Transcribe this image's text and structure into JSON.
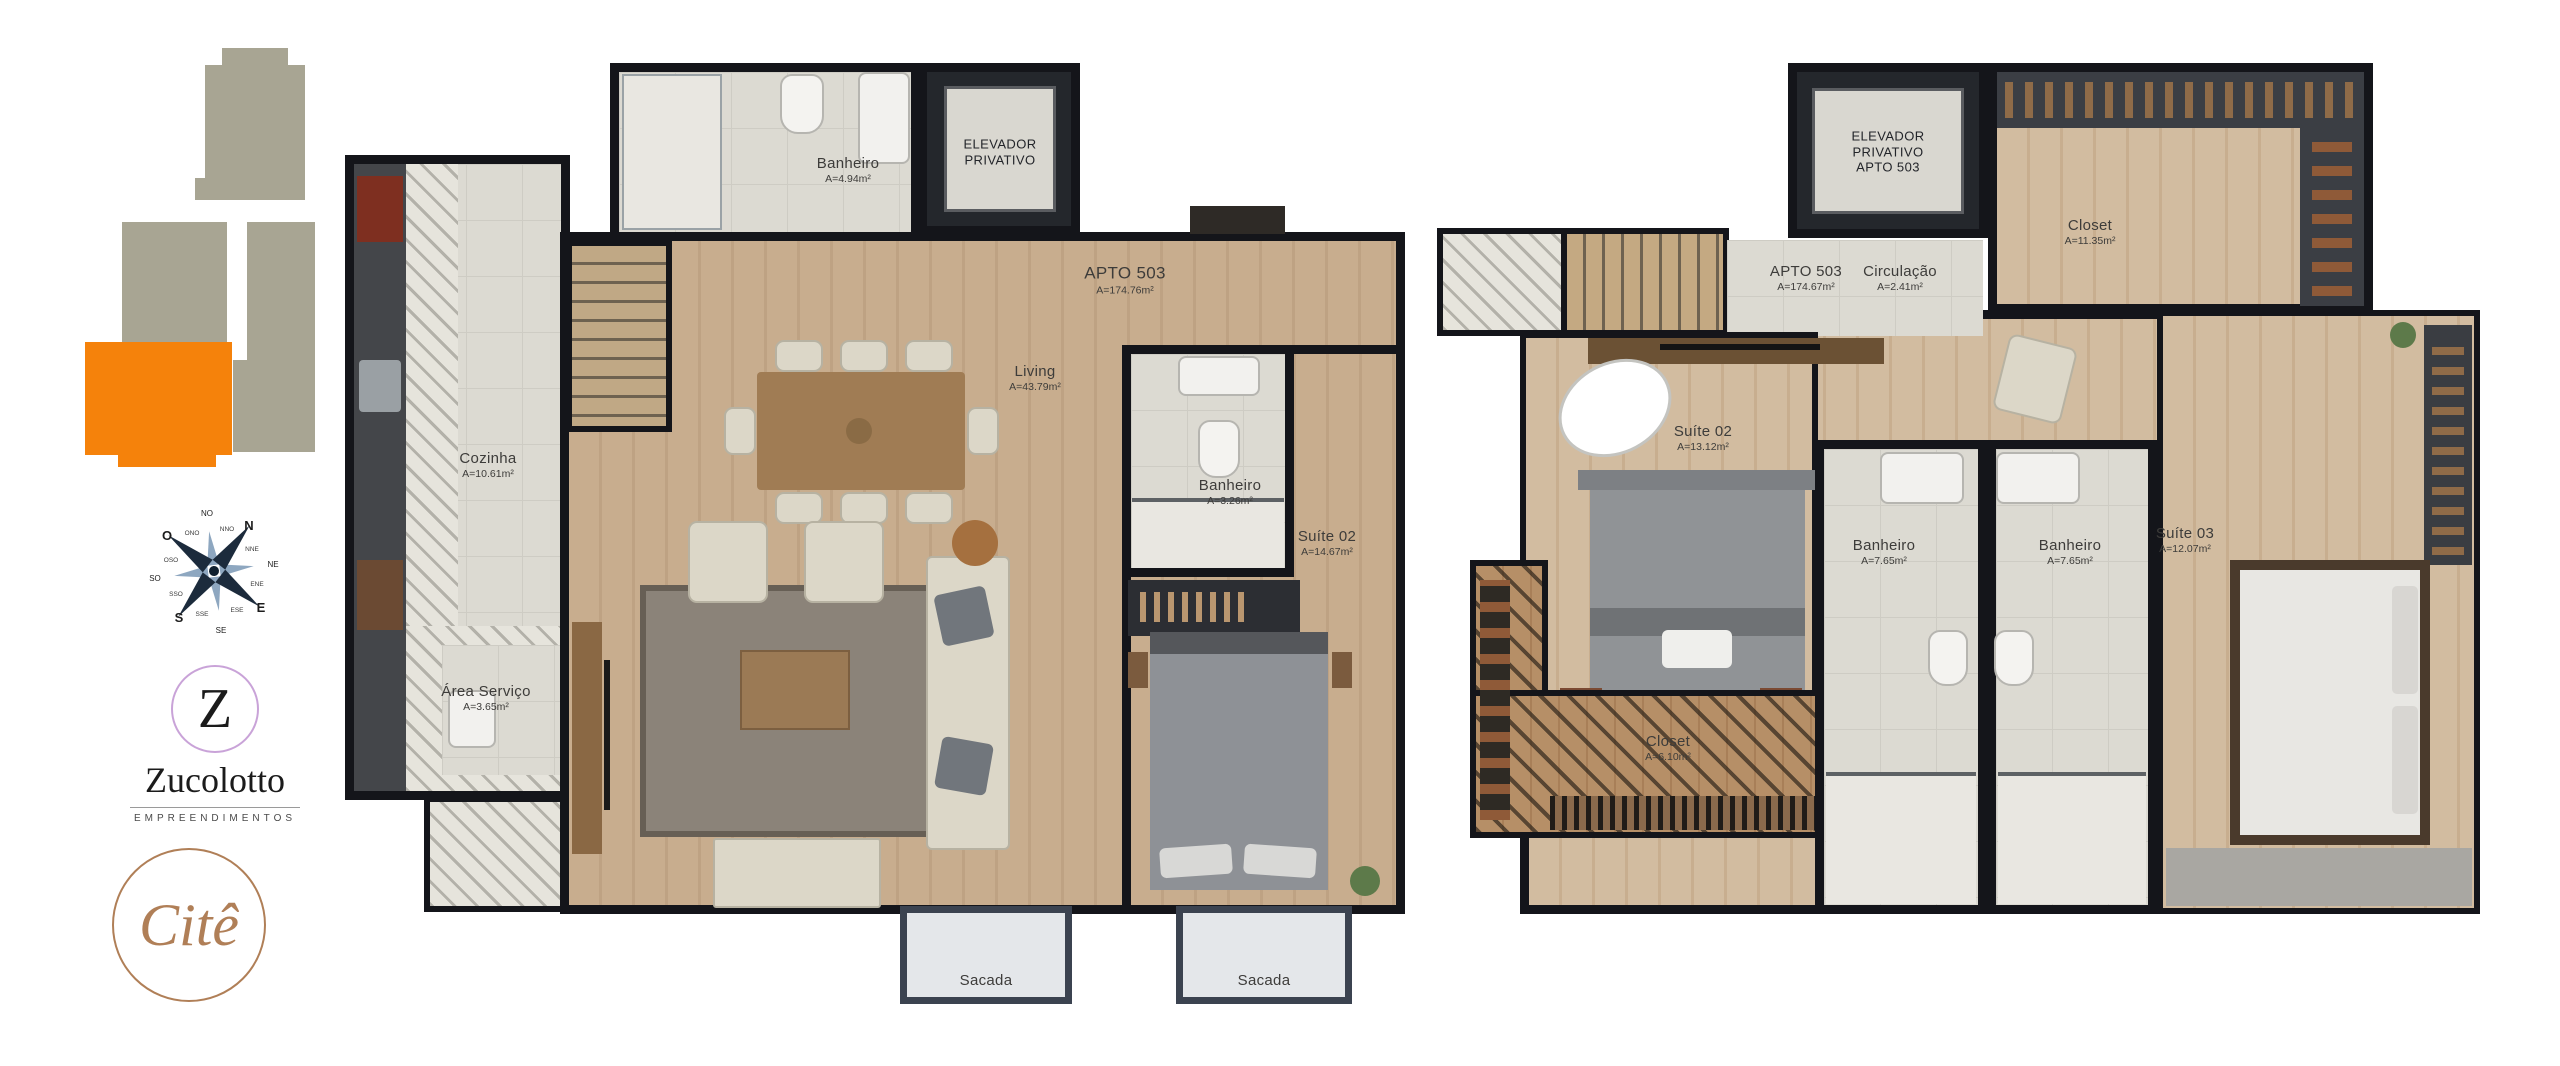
{
  "sidebar": {
    "building_locator": {
      "base_color": "#a8a593",
      "accent_color": "#f5820b"
    },
    "compass": {
      "cardinals": [
        "N",
        "E",
        "S",
        "O"
      ],
      "intercardinals": [
        "NE",
        "SE",
        "SO",
        "NO"
      ],
      "secondary": [
        "NNE",
        "ENE",
        "ESE",
        "SSE",
        "SSO",
        "OSO",
        "ONO",
        "NNO"
      ]
    },
    "zucolotto": {
      "initial": "Z",
      "name": "Zucolotto",
      "tagline": "EMPREENDIMENTOS"
    },
    "cite": {
      "name": "Citê"
    }
  },
  "lower_plan": {
    "apto": {
      "name": "APTO 503",
      "area": "A=174.76m²"
    },
    "banheiro_top": {
      "name": "Banheiro",
      "area": "A=4.94m²"
    },
    "elevador": {
      "line1": "ELEVADOR",
      "line2": "PRIVATIVO"
    },
    "cozinha": {
      "name": "Cozinha",
      "area": "A=10.61m²"
    },
    "area_servico": {
      "name": "Área Serviço",
      "area": "A=3.65m²"
    },
    "living": {
      "name": "Living",
      "area": "A=43.79m²"
    },
    "banheiro_suite": {
      "name": "Banheiro",
      "area": "A=3.26m²"
    },
    "suite02": {
      "name": "Suíte 02",
      "area": "A=14.67m²"
    },
    "sacada_left": {
      "name": "Sacada"
    },
    "sacada_right": {
      "name": "Sacada"
    }
  },
  "upper_plan": {
    "elevador": {
      "line1": "ELEVADOR",
      "line2": "PRIVATIVO",
      "line3": "APTO 503"
    },
    "closet_top": {
      "name": "Closet",
      "area": "A=11.35m²"
    },
    "apto": {
      "name": "APTO 503",
      "area": "A=174.67m²"
    },
    "circulacao": {
      "name": "Circulação",
      "area": "A=2.41m²"
    },
    "suite02": {
      "name": "Suíte 02",
      "area": "A=13.12m²"
    },
    "banheiro_left": {
      "name": "Banheiro",
      "area": "A=7.65m²"
    },
    "banheiro_right": {
      "name": "Banheiro",
      "area": "A=7.65m²"
    },
    "suite03": {
      "name": "Suíte 03",
      "area": "A=12.07m²"
    },
    "closet_bottom": {
      "name": "Closet",
      "area": "A=6.10m²"
    }
  }
}
